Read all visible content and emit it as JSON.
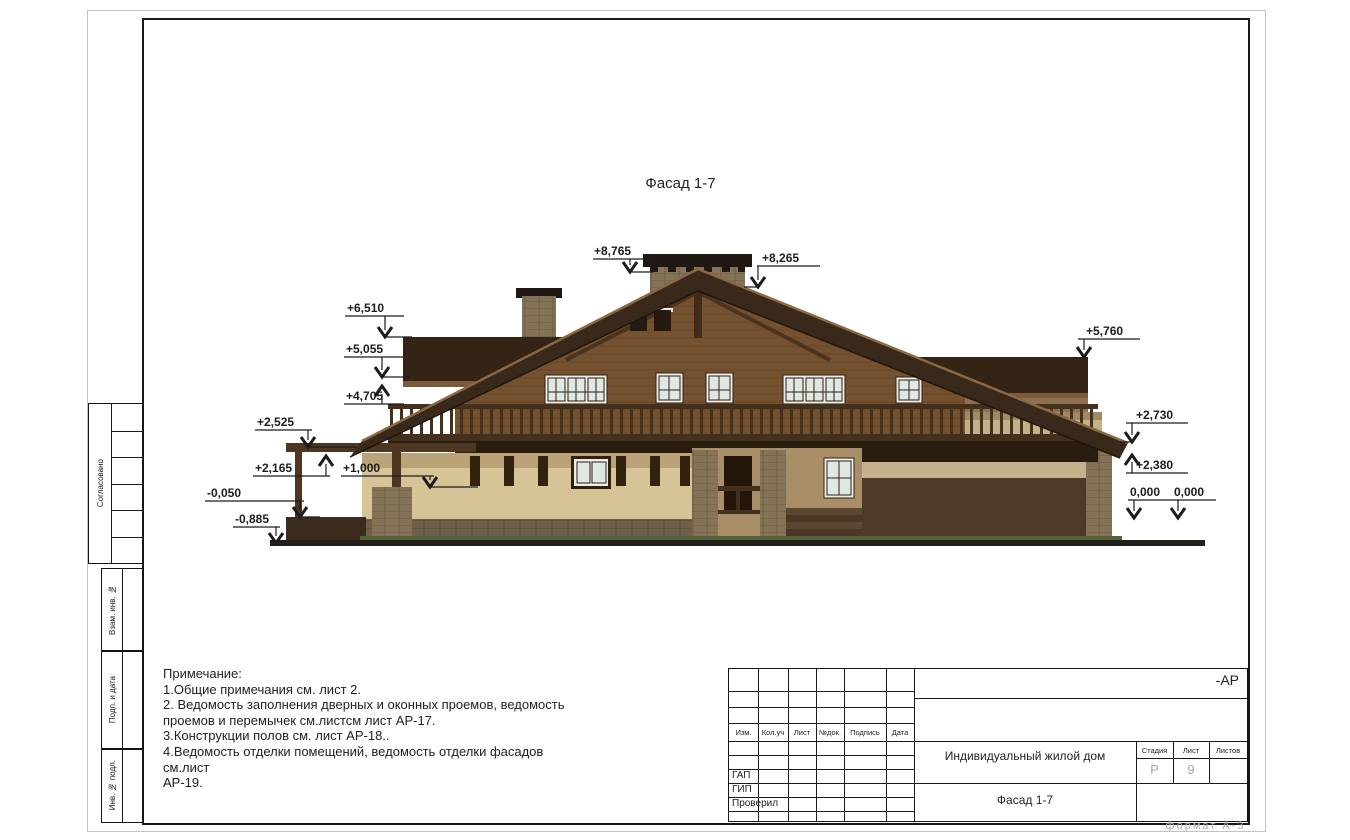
{
  "sheet": {
    "drawing_title": "Фасад 1-7",
    "format_label": "формат А-3"
  },
  "side_panel": {
    "approved_label": "Согласовано",
    "replace_inv_label": "Взам. инв. №",
    "sign_date_label": "Подп. и дата",
    "inv_original_label": "Инв. № подл."
  },
  "notes": {
    "lines": [
      "Примечание:",
      "1.Общие примечания  см. лист 2.",
      "2. Ведомость заполнения дверных и оконных проемов, ведомость",
      "проемов и перемычек см.листсм лист АР-17.",
      "3.Конструкции полов см. лист АР-18..",
      "4.Ведомость отделки помещений, ведомость отделки фасадов см.лист",
      "АР-19."
    ]
  },
  "elevation_markers": [
    "+8,765",
    "+8,265",
    "+6,510",
    "+5,055",
    "+4,705",
    "+2,525",
    "+2,165",
    "+1,000",
    "-0,050",
    "-0,885",
    "+5,760",
    "+2,730",
    "+2,380",
    "0,000",
    "0,000"
  ],
  "title_block": {
    "doc_code": "-АР",
    "columns": {
      "izm": "Изм.",
      "kol": "Кол.уч",
      "list": "Лист",
      "ndoc": "№док.",
      "podpis": "Подпись",
      "data": "Дата"
    },
    "roles": [
      "ГАП",
      "ГИП",
      "Проверил"
    ],
    "project_name": "Индивидуальный жилой дом",
    "sheet_title": "Фасад 1-7",
    "stage_label": "Стадия",
    "stage_value": "Р",
    "sheet_label": "Лист",
    "sheet_value": "9",
    "sheets_label": "Листов"
  },
  "colors": {
    "roof": "#38291a",
    "wall_wood": "#74512f",
    "stucco": "#d6c496",
    "stone": "#847357",
    "frame": "#181818",
    "format_text": "#aab0b6"
  }
}
